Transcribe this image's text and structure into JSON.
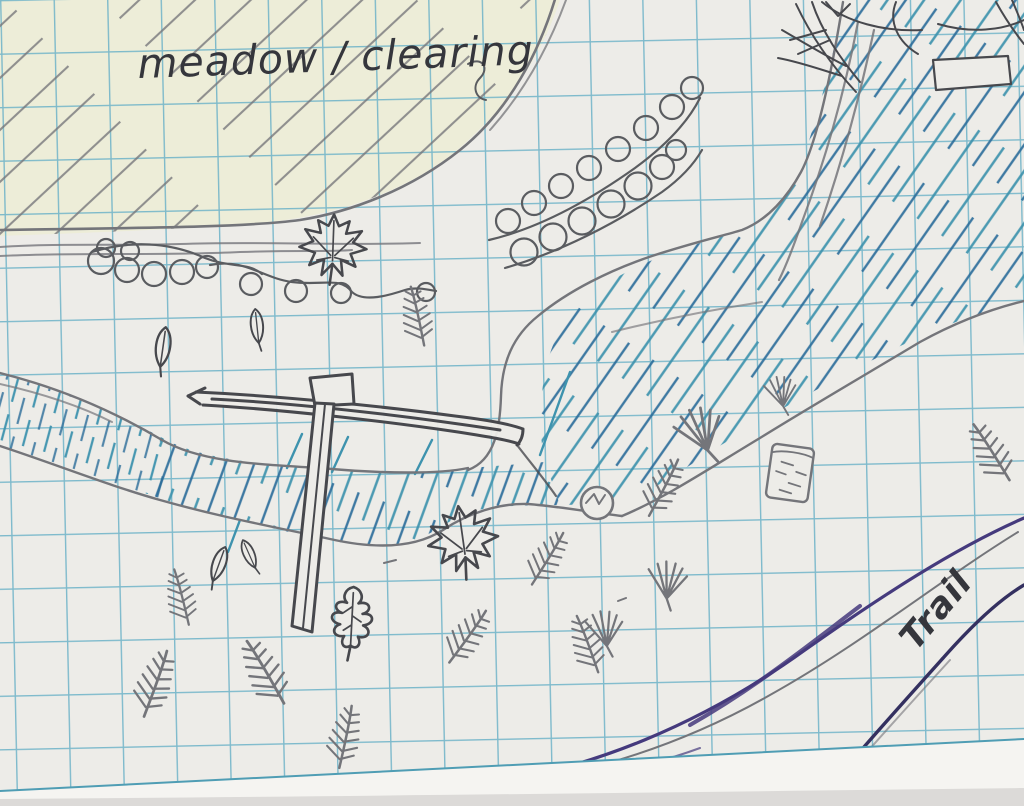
{
  "title": "Hand-drawn trail map sketch on graph paper",
  "labels": {
    "meadow": "meadow / clearing",
    "trail": "Trail"
  },
  "features": [
    {
      "name": "meadow-clearing",
      "kind": "pencil-hatched area with yellow highlight, top left"
    },
    {
      "name": "stream",
      "kind": "blue-hatched watercourse curving from top right down across the middle to the left edge"
    },
    {
      "name": "bridge-signpost",
      "kind": "T-shaped dark pencil structure crossing the stream"
    },
    {
      "name": "shrub-scribbles",
      "kind": "looping scribble bushes below the meadow edge"
    },
    {
      "name": "bush-row",
      "kind": "diagonal chain of loop bushes, top centre"
    },
    {
      "name": "maple-leaf-markers",
      "count": 2
    },
    {
      "name": "oak-leaf-marker",
      "count": 1
    },
    {
      "name": "simple-leaf-markers",
      "count": 4
    },
    {
      "name": "conifer-sprig-markers",
      "count": 10
    },
    {
      "name": "grass-tuft-markers",
      "count": 4
    },
    {
      "name": "boulder-circle-marker",
      "count": 1
    },
    {
      "name": "log-marker",
      "count": 1
    },
    {
      "name": "hut-outline",
      "kind": "small pencil rectangle near top right"
    },
    {
      "name": "fallen-tree-scribble",
      "kind": "pencil scribble at top right corner"
    },
    {
      "name": "trail-path",
      "kind": "two sweeping purple ink curves, bottom right"
    }
  ],
  "colors": {
    "paper": "#edece8",
    "paper_margin": "#f5f4f1",
    "grid": "#72b5c9",
    "grid_dark": "#4f9db4",
    "pencil": "#74757a",
    "pencil_dark": "#47484d",
    "loops": "#5a5c60",
    "ink_teal": "#3e93ae",
    "ink_blue": "#2b6d9a",
    "trail": "#453a7d",
    "trail_dark": "#343060",
    "meadow_tint": "#edeecf",
    "label_ink": "#35363c",
    "shadow": "#c7c5c2"
  }
}
